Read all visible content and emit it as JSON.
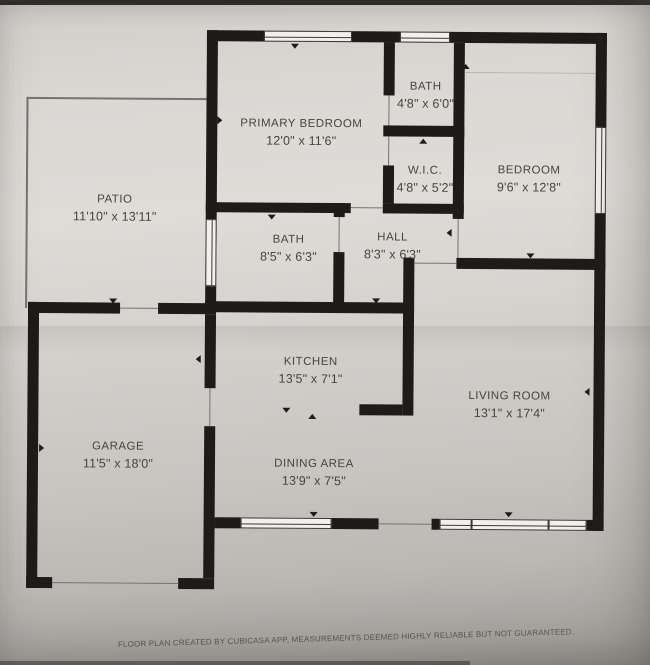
{
  "plan": {
    "rooms": [
      {
        "name": "PRIMARY BEDROOM",
        "dims": "12'0\" x 11'6\""
      },
      {
        "name": "BATH",
        "dims": "4'8\" x 6'0\""
      },
      {
        "name": "W.I.C.",
        "dims": "4'8\" x 5'2\""
      },
      {
        "name": "BEDROOM",
        "dims": "9'6\" x 12'8\""
      },
      {
        "name": "PATIO",
        "dims": "11'10\" x 13'11\""
      },
      {
        "name": "BATH",
        "dims": "8'5\" x 6'3\""
      },
      {
        "name": "HALL",
        "dims": "8'3\" x 6'3\""
      },
      {
        "name": "KITCHEN",
        "dims": "13'5\" x 7'1\""
      },
      {
        "name": "LIVING ROOM",
        "dims": "13'1\" x 17'4\""
      },
      {
        "name": "GARAGE",
        "dims": "11'5\" x 18'0\""
      },
      {
        "name": "DINING AREA",
        "dims": "13'9\" x 7'5\""
      }
    ],
    "footer": "FLOOR PLAN CREATED BY CUBICASA APP, MEASUREMENTS DEEMED HIGHLY RELIABLE BUT NOT GUARANTEED.",
    "colors": {
      "wall": "#1d1c1a",
      "paper": "#d6d4cf",
      "text": "#46453f"
    }
  }
}
